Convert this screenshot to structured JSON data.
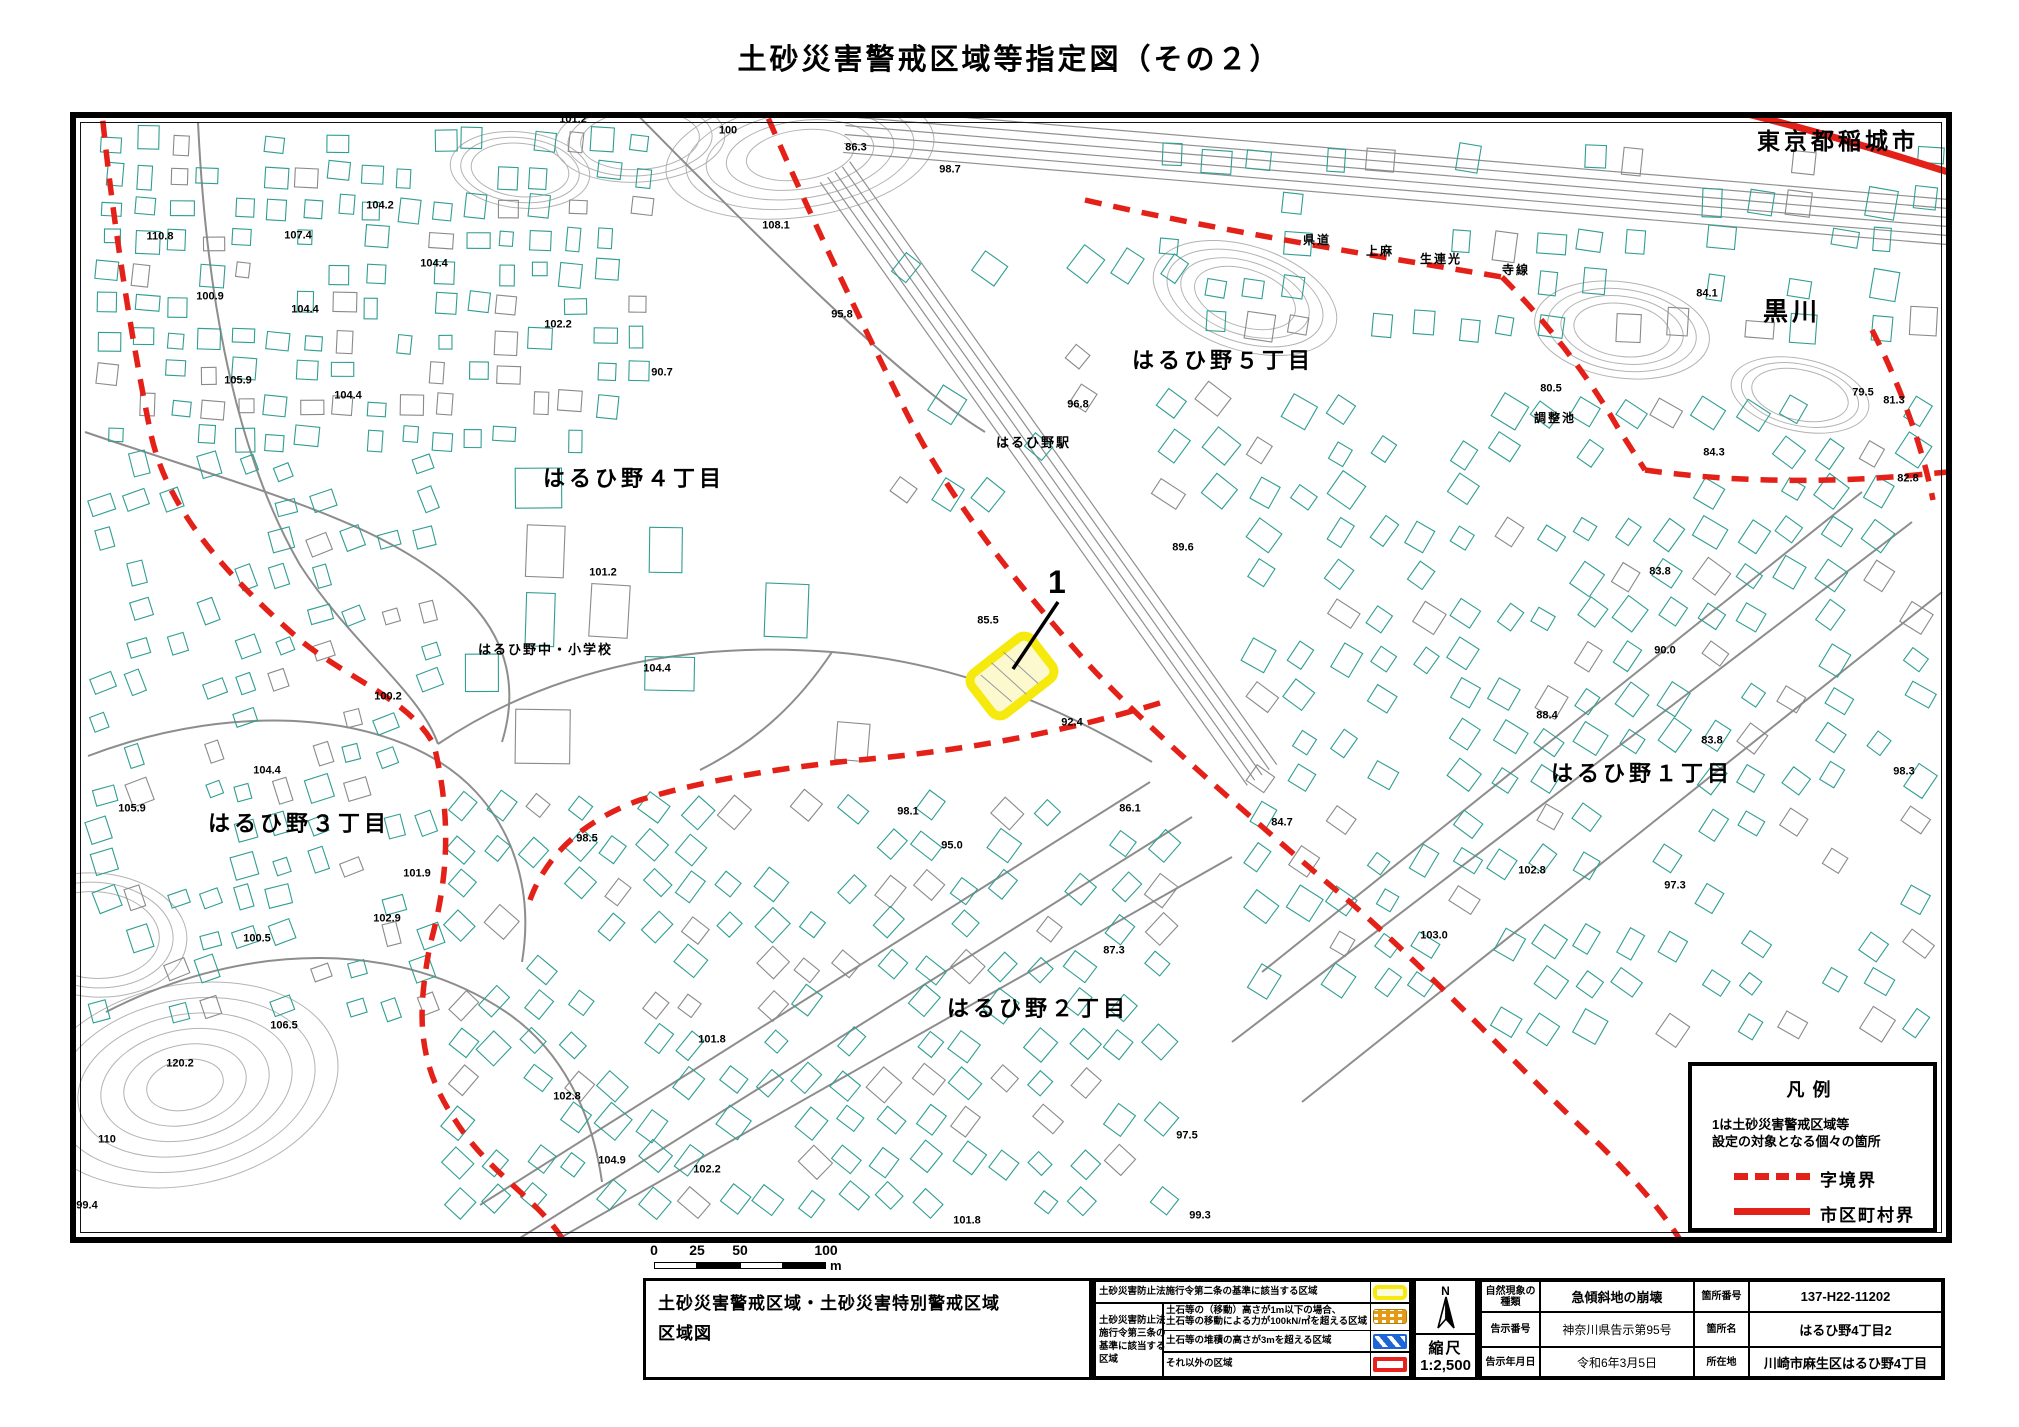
{
  "page_title": "土砂災害警戒区域等指定図（その２）",
  "colors": {
    "boundary_dashed_red": "#e32119",
    "boundary_solid_red": "#e32119",
    "designated_area_outline": "#f6e90d",
    "designated_area_fill": "#fcf9cf",
    "building_outline_teal": "#2f9e92",
    "road_gray": "#8d8d8d",
    "zone_yellow": "#f6e90d",
    "zone_orange": "#e59a16",
    "zone_blue": "#1e66d6",
    "zone_red": "#e8211d"
  },
  "map": {
    "designated_area": {
      "number": "1"
    },
    "area_labels": [
      {
        "text": "東京都稲城市",
        "x": 1757,
        "y": 130,
        "s": 23
      },
      {
        "text": "黒川",
        "x": 1763,
        "y": 300,
        "s": 25
      },
      {
        "text": "はるひ野５丁目",
        "x": 1132,
        "y": 350,
        "s": 22
      },
      {
        "text": "はるひ野４丁目",
        "x": 543,
        "y": 468,
        "s": 22
      },
      {
        "text": "はるひ野３丁目",
        "x": 208,
        "y": 813,
        "s": 22
      },
      {
        "text": "はるひ野２丁目",
        "x": 947,
        "y": 998,
        "s": 22
      },
      {
        "text": "はるひ野１丁目",
        "x": 1551,
        "y": 763,
        "s": 22
      },
      {
        "text": "はるひ野駅",
        "x": 996,
        "y": 436,
        "s": 13
      },
      {
        "text": "はるひ野中・小学校",
        "x": 478,
        "y": 643,
        "s": 13
      },
      {
        "text": "調整池",
        "x": 1534,
        "y": 412,
        "s": 12
      },
      {
        "text": "県道",
        "x": 1303,
        "y": 234,
        "s": 12
      },
      {
        "text": "上麻",
        "x": 1366,
        "y": 245,
        "s": 12
      },
      {
        "text": "生連光",
        "x": 1420,
        "y": 253,
        "s": 12
      },
      {
        "text": "寺線",
        "x": 1502,
        "y": 264,
        "s": 12
      },
      {
        "text": "1",
        "x": 1048,
        "y": 566,
        "s": 32
      }
    ],
    "spot_heights": [
      {
        "v": "101.2",
        "x": 573,
        "y": 120
      },
      {
        "v": "100",
        "x": 728,
        "y": 131
      },
      {
        "v": "86.3",
        "x": 856,
        "y": 148
      },
      {
        "v": "98.7",
        "x": 950,
        "y": 170
      },
      {
        "v": "85.4",
        "x": 1268,
        "y": 106
      },
      {
        "v": "110.8",
        "x": 160,
        "y": 237
      },
      {
        "v": "107.4",
        "x": 298,
        "y": 236
      },
      {
        "v": "104.2",
        "x": 380,
        "y": 206
      },
      {
        "v": "104.4",
        "x": 434,
        "y": 264
      },
      {
        "v": "108.1",
        "x": 776,
        "y": 226
      },
      {
        "v": "100.9",
        "x": 210,
        "y": 297
      },
      {
        "v": "104.4",
        "x": 305,
        "y": 310
      },
      {
        "v": "102.2",
        "x": 558,
        "y": 325
      },
      {
        "v": "90.7",
        "x": 662,
        "y": 373
      },
      {
        "v": "95.8",
        "x": 842,
        "y": 315
      },
      {
        "v": "96.8",
        "x": 1078,
        "y": 405
      },
      {
        "v": "105.9",
        "x": 238,
        "y": 381
      },
      {
        "v": "104.4",
        "x": 348,
        "y": 396
      },
      {
        "v": "89.6",
        "x": 1183,
        "y": 548
      },
      {
        "v": "101.2",
        "x": 603,
        "y": 573
      },
      {
        "v": "100.2",
        "x": 388,
        "y": 697
      },
      {
        "v": "104.4",
        "x": 657,
        "y": 669
      },
      {
        "v": "85.5",
        "x": 988,
        "y": 621
      },
      {
        "v": "92.4",
        "x": 1072,
        "y": 723
      },
      {
        "v": "98.5",
        "x": 587,
        "y": 839
      },
      {
        "v": "95.0",
        "x": 952,
        "y": 846
      },
      {
        "v": "98.1",
        "x": 908,
        "y": 812
      },
      {
        "v": "104.4",
        "x": 267,
        "y": 771
      },
      {
        "v": "101.9",
        "x": 417,
        "y": 874
      },
      {
        "v": "102.9",
        "x": 387,
        "y": 919
      },
      {
        "v": "100.5",
        "x": 257,
        "y": 939
      },
      {
        "v": "105.9",
        "x": 132,
        "y": 809
      },
      {
        "v": "106.5",
        "x": 284,
        "y": 1026
      },
      {
        "v": "120.2",
        "x": 180,
        "y": 1064
      },
      {
        "v": "110",
        "x": 107,
        "y": 1140
      },
      {
        "v": "101.8",
        "x": 712,
        "y": 1040
      },
      {
        "v": "102.8",
        "x": 567,
        "y": 1097
      },
      {
        "v": "104.9",
        "x": 612,
        "y": 1161
      },
      {
        "v": "99.4",
        "x": 87,
        "y": 1206
      },
      {
        "v": "102.2",
        "x": 707,
        "y": 1170
      },
      {
        "v": "97.5",
        "x": 1187,
        "y": 1136
      },
      {
        "v": "87.3",
        "x": 1114,
        "y": 951
      },
      {
        "v": "101.8",
        "x": 967,
        "y": 1221
      },
      {
        "v": "99.3",
        "x": 1200,
        "y": 1216
      },
      {
        "v": "86.1",
        "x": 1130,
        "y": 809
      },
      {
        "v": "84.7",
        "x": 1282,
        "y": 823
      },
      {
        "v": "103.0",
        "x": 1434,
        "y": 936
      },
      {
        "v": "102.8",
        "x": 1532,
        "y": 871
      },
      {
        "v": "97.3",
        "x": 1675,
        "y": 886
      },
      {
        "v": "88.4",
        "x": 1547,
        "y": 716
      },
      {
        "v": "83.8",
        "x": 1712,
        "y": 741
      },
      {
        "v": "90.0",
        "x": 1665,
        "y": 651
      },
      {
        "v": "84.1",
        "x": 1707,
        "y": 294
      },
      {
        "v": "80.5",
        "x": 1551,
        "y": 389
      },
      {
        "v": "79.5",
        "x": 1863,
        "y": 393
      },
      {
        "v": "84.3",
        "x": 1714,
        "y": 453
      },
      {
        "v": "81.3",
        "x": 1894,
        "y": 401
      },
      {
        "v": "82.8",
        "x": 1908,
        "y": 479
      },
      {
        "v": "98.3",
        "x": 1904,
        "y": 772
      },
      {
        "v": "83.8",
        "x": 1660,
        "y": 572
      }
    ],
    "legend": {
      "title": "凡例",
      "note_line1": "1は土砂災害警戒区域等",
      "note_line2": "設定の対象となる個々の箇所",
      "dashed_label": "字境界",
      "solid_label": "市区町村界"
    },
    "scale_bar": {
      "ticks": [
        "0",
        "25",
        "50",
        "100"
      ],
      "unit": "m"
    }
  },
  "info_table": {
    "title_line1": "土砂災害警戒区域・土砂災害特別警戒区域",
    "title_line2": "区域図",
    "zone_table": {
      "row1_label": "土砂災害防止法施行令第二条の基準に該当する区域",
      "group_label_lines": [
        "土砂災害防止法",
        "施行令第三条の",
        "基準に該当する",
        "区域"
      ],
      "rows": [
        {
          "lines": [
            "土石等の（移動）高さが1m以下の場合、",
            "土石等の移動による力が100kN/㎡を超える区域"
          ],
          "swatch": "orange"
        },
        {
          "lines": [
            "土石等の堆積の高さが3mを超える区域"
          ],
          "swatch": "blue"
        },
        {
          "lines": [
            "それ以外の区域"
          ],
          "swatch": "red"
        }
      ]
    },
    "compass": {
      "north_label": "N",
      "scale_label": "縮尺",
      "scale_value": "1:2,500"
    },
    "details": {
      "rows": [
        {
          "label1": "自然現象の種類",
          "value1": "急傾斜地の崩壊",
          "label2": "箇所番号",
          "value2": "137-H22-11202"
        },
        {
          "label1": "告示番号",
          "value1": "神奈川県告示第95号",
          "label2": "箇所名",
          "value2": "はるひ野4丁目2"
        },
        {
          "label1": "告示年月日",
          "value1": "令和6年3月5日",
          "label2": "所在地",
          "value2": "川崎市麻生区はるひ野4丁目"
        }
      ]
    }
  }
}
